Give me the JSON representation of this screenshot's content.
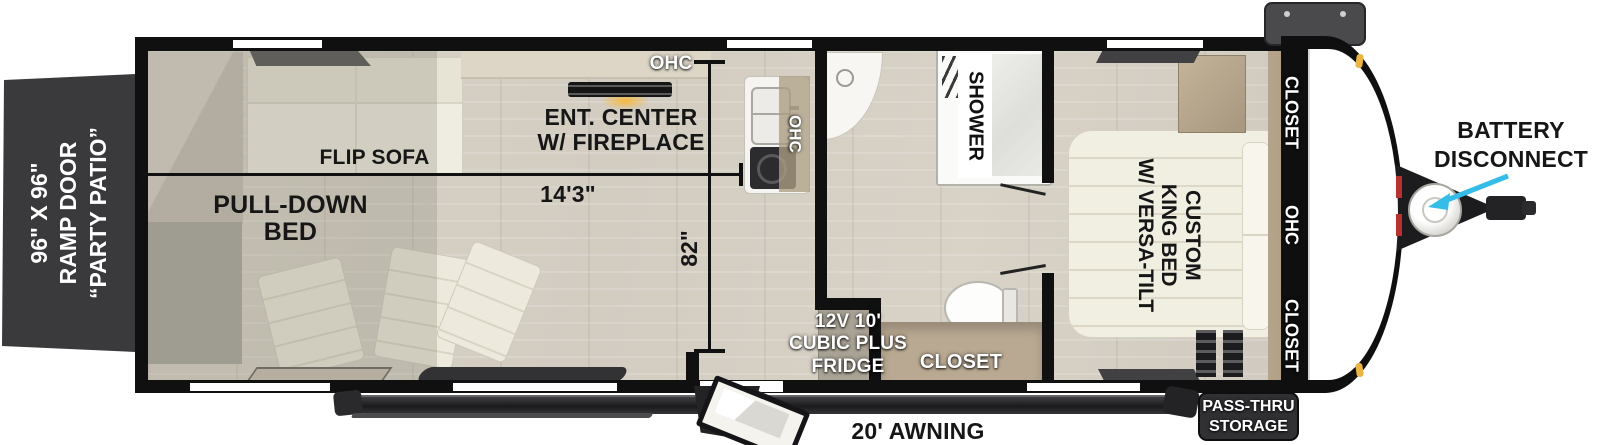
{
  "ramp_door": {
    "lines": [
      "96\" X 96\"",
      "RAMP DOOR",
      "“PARTY PATIO”"
    ]
  },
  "garage": {
    "flip_sofa_label": "FLIP SOFA",
    "pull_down_bed_lines": [
      "PULL-DOWN",
      "BED"
    ],
    "ent_center_lines": [
      "ENT. CENTER",
      "W/ FIREPLACE"
    ],
    "ohc_label": "OHC",
    "width_dim": "14'3\"",
    "height_dim": "82\""
  },
  "kitchen": {
    "ohc_label": "OHC"
  },
  "bathroom": {
    "shower_label": "SHOWER",
    "closet_label": "CLOSET",
    "fridge_lines": [
      "12V 10'",
      "CUBIC PLUS",
      "FRIDGE"
    ]
  },
  "bedroom": {
    "bed_lines": [
      "CUSTOM",
      "KING BED",
      "W/ VERSA-TILT"
    ],
    "closet_top_label": "CLOSET",
    "ohc_label": "OHC",
    "closet_bottom_label": "CLOSET"
  },
  "exterior": {
    "battery_disconnect_lines": [
      "BATTERY",
      "DISCONNECT"
    ],
    "pass_thru_lines": [
      "PASS-THRU",
      "STORAGE"
    ],
    "awning_label": "20' AWNING"
  },
  "colors": {
    "arrow_cyan": "#35bce8",
    "ramp_door_gray": "#3a393c",
    "wall_black": "#101010",
    "closet_tan": "#b5a48c",
    "fireplace_glow_orange": "#f6b93d"
  }
}
